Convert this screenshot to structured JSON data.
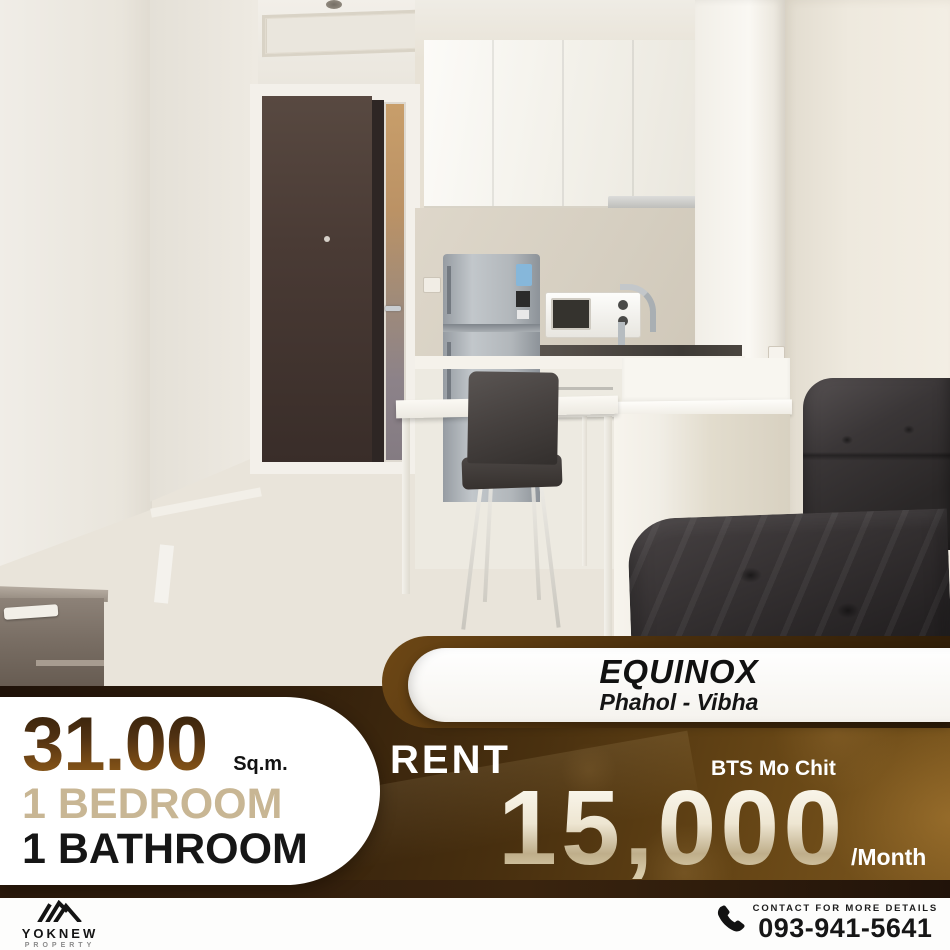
{
  "listing": {
    "project_name": "EQUINOX",
    "project_location": "Phahol - Vibha",
    "area_value": "31.00",
    "area_unit": "Sq.m.",
    "bedrooms_label": "1 BEDROOM",
    "bathrooms_label": "1 BATHROOM",
    "deal_type": "RENT",
    "transit_station": "BTS Mo Chit",
    "price": "15,000",
    "price_period": "/Month"
  },
  "brand": {
    "name": "YOKNEW",
    "division": "PROPERTY",
    "logo_icon": "roof-icon"
  },
  "contact": {
    "label": "CONTACT FOR MORE DETAILS",
    "phone": "093-941-5641",
    "icon": "phone-icon"
  },
  "colors": {
    "panel_brown_dark": "#2a1808",
    "panel_brown_light": "#7d581f",
    "area_text_brown": "#6f4514",
    "bedroom_text_tan": "#c8b694",
    "price_champagne": "#e9dfc6",
    "banner_white": "#ffffff",
    "divider_band": "#2b1a0c"
  }
}
